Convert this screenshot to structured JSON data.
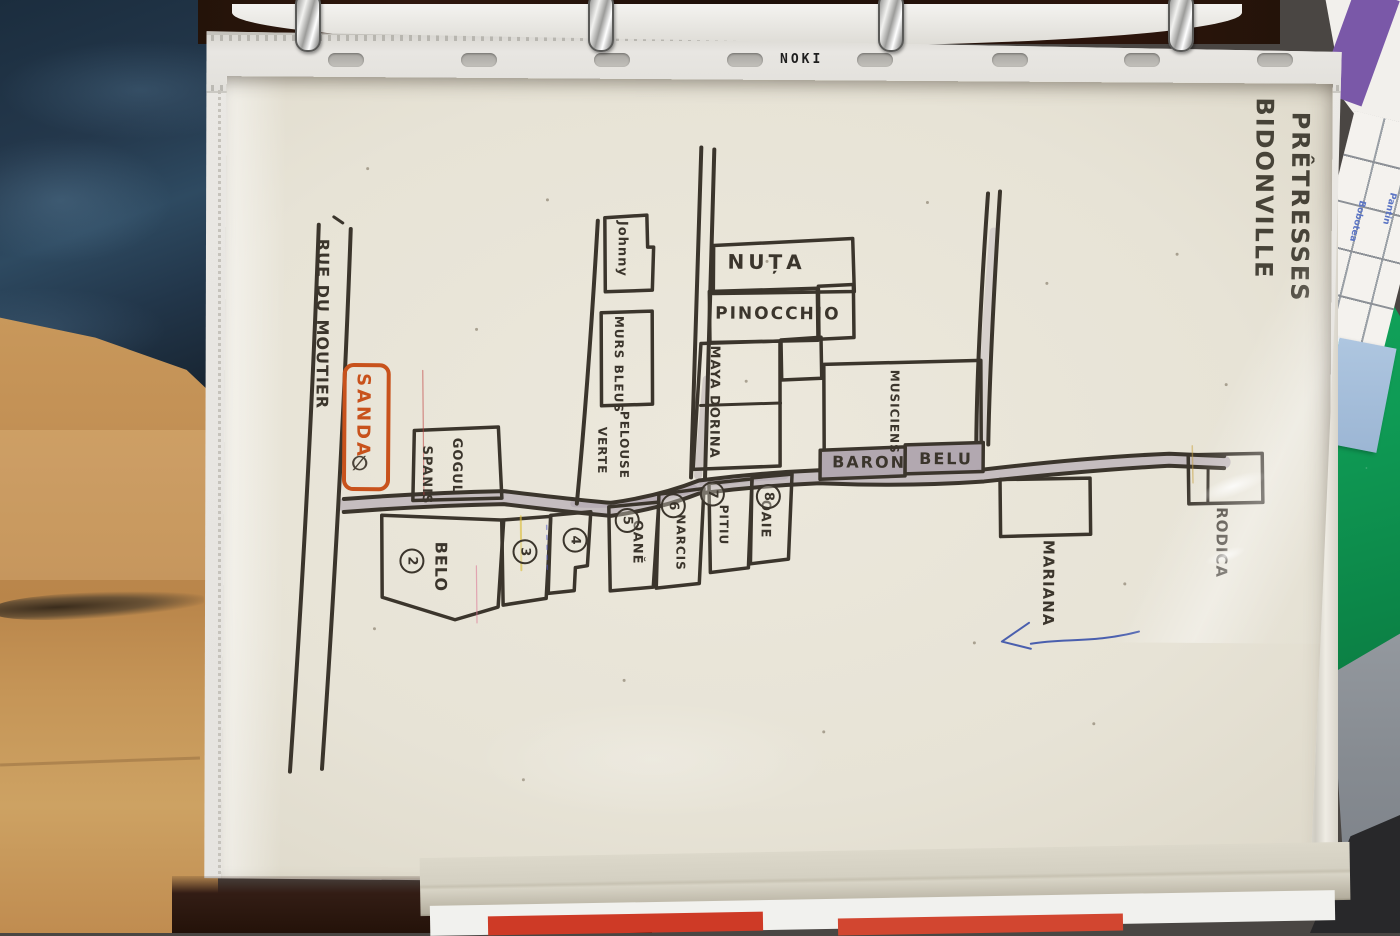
{
  "binder": {
    "brand": "NOKI"
  },
  "map": {
    "title_line1": "BIDONVILLE",
    "title_line2": "PRÊTRESSES",
    "street": "RUE DU MOUTIER",
    "sanda": "SANDA",
    "sanda_symbol": "∅",
    "gogul_line1": "GOGUL",
    "gogul_line2": "SPANIS",
    "johnny": "Johnny",
    "murs_bleus": "MURS BLEUS",
    "pelouse_line1": "PELOUSE",
    "pelouse_line2": "VERTE",
    "nuta": "NUȚA",
    "pinocchio": "PINOCCHIO",
    "maya_dorina": "MAYA DORINA",
    "musiciens": "MUSICIENS",
    "baron": "BARON",
    "belu": "BELU",
    "mariana": "MARIANA",
    "rodica": "RODICA",
    "houses": [
      {
        "num": "2",
        "label": "BELO"
      },
      {
        "num": "3",
        "label": ""
      },
      {
        "num": "4",
        "label": ""
      },
      {
        "num": "5",
        "label": "OANĔ"
      },
      {
        "num": "6",
        "label": "NARCIS"
      },
      {
        "num": "7",
        "label": "PITIU"
      },
      {
        "num": "8",
        "label": "OAIE"
      }
    ]
  },
  "side_papers": {
    "label1": "Pantin",
    "label2": "Bobotea"
  },
  "colors": {
    "ink": "#3b352c",
    "sanda_orange": "#c8521c",
    "road_shade": "#c5bdbf",
    "green_folder": "#0f9b55",
    "purple_stripe": "#7a58a8",
    "blue_card": "#a3bdd9",
    "denim": "#24384c",
    "wood_floor": "#c08d52",
    "blue_pen": "#4a5fae"
  }
}
